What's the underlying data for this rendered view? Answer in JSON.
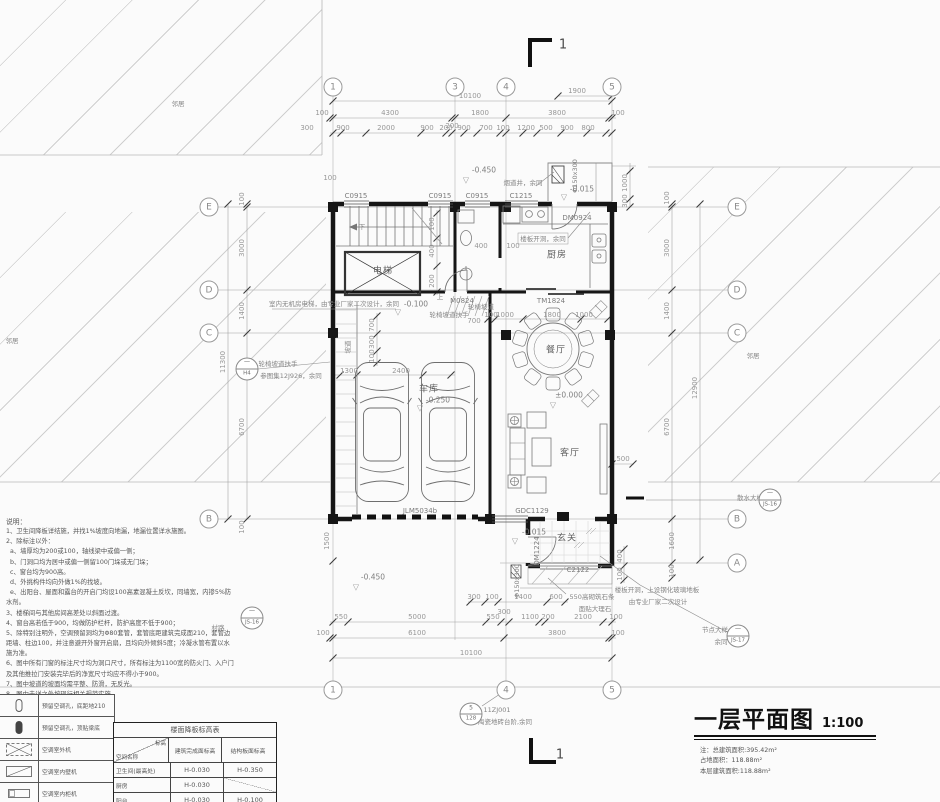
{
  "title_block": {
    "title": "一层平面图",
    "scale": "1:100",
    "notes": [
      "注：总建筑面积:395.42m²",
      "占地面积：118.88m²",
      "本层建筑面积:118.88m²"
    ]
  },
  "colors": {
    "paper": "#fbfbfb",
    "wall": "#161616",
    "medium_line": "#707070",
    "dim_text": "#979797",
    "hatch": "#cfcfcf"
  },
  "notes": {
    "heading": "说明：",
    "items": [
      "1、卫生间降板详结施，并找1%坡度向地漏，地漏位置详水施图。",
      "2、除标注以外：",
      "  a、墙厚均为200或100，轴线梁中或偏一侧；",
      "  b、门洞口均为居中或偏一侧留100门垛或无门垛；",
      "  c、窗台均为900高。",
      "  d、外挑构件均向外做1%的找坡。",
      "  e、出阳台、屋面和露台的开启门均设100高素混凝土反坎，同墙宽，内掺5%防水剂。",
      "3、楼梯间与其他房间高差处以斜面过渡。",
      "4、窗台高若低于900，均做防护栏杆，防护高度不低于900；",
      "5、除特别注明外，空调预留洞均为Φ80套管，套管底距建筑完成面210，套管边距墙、柱边100，并注意避开外窗开启扇，且均向外倾斜5度；冷凝水管布置以水施为准。",
      "6、图中所有门窗的标注尺寸均为洞口尺寸，所有标注为1100宽的防火门、入户门及其他推拉门安装完毕后的净宽尺寸均应不得小于900。",
      "7、图中坡道的坡面均需平整、防滑，无反光。",
      "8、图中未详之处按现行相关规范实施。"
    ]
  },
  "legend": {
    "rows": [
      {
        "symbol": "ac-hole-pill-outline",
        "desc": "预留空调孔，底距地210"
      },
      {
        "symbol": "ac-hole-pill-filled",
        "desc": "预留空调孔，顶贴梁底"
      },
      {
        "symbol": "ac-outdoor-unit",
        "desc": "空调室外机"
      },
      {
        "symbol": "ac-indoor-wall-unit",
        "desc": "空调室内壁机"
      },
      {
        "symbol": "ac-indoor-cabinet-unit",
        "desc": "空调室内柜机"
      }
    ]
  },
  "elevation_table": {
    "title": "楼面降板标高表",
    "corner_top": "标高",
    "corner_bottom": "空间名称",
    "headers": [
      "建筑完成面标高",
      "结构板面标高"
    ],
    "rows": [
      [
        "卫生间(最高处)",
        "H-0.030",
        "H-0.350"
      ],
      [
        "厨房",
        "H-0.030",
        ""
      ],
      [
        "阳台",
        "H-0.030",
        "H-0.100"
      ]
    ]
  },
  "detail_bubbles": [
    {
      "n": "detail-bubble-h4",
      "top": "一",
      "bottom": "H4",
      "x": 247,
      "y": 369
    },
    {
      "n": "detail-bubble-steps",
      "top": "5",
      "bottom": "128",
      "x": 471,
      "y": 714
    },
    {
      "n": "detail-bubble-node",
      "top": "一",
      "bottom": "JS-17",
      "x": 738,
      "y": 636
    },
    {
      "n": "detail-bubble-apron",
      "top": "一",
      "bottom": "JS-16",
      "x": 770,
      "y": 500
    },
    {
      "n": "detail-bubble-road",
      "top": "一",
      "bottom": "JS-16",
      "x": 252,
      "y": 618
    }
  ],
  "plan_labels": [
    {
      "n": "grid-bubble-1-top",
      "t": "1",
      "x": 333,
      "y": 87,
      "c": "bubble"
    },
    {
      "n": "grid-bubble-3-top",
      "t": "3",
      "x": 455,
      "y": 87,
      "c": "bubble"
    },
    {
      "n": "grid-bubble-4-top",
      "t": "4",
      "x": 506,
      "y": 87,
      "c": "bubble"
    },
    {
      "n": "grid-bubble-5-top",
      "t": "5",
      "x": 612,
      "y": 87,
      "c": "bubble"
    },
    {
      "n": "grid-bubble-1-bottom",
      "t": "1",
      "x": 333,
      "y": 690,
      "c": "bubble"
    },
    {
      "n": "grid-bubble-4-bottom",
      "t": "4",
      "x": 506,
      "y": 690,
      "c": "bubble"
    },
    {
      "n": "grid-bubble-5-bottom",
      "t": "5",
      "x": 612,
      "y": 690,
      "c": "bubble"
    },
    {
      "n": "grid-bubble-e-left",
      "t": "E",
      "x": 209,
      "y": 207,
      "c": "bubble"
    },
    {
      "n": "grid-bubble-d-left",
      "t": "D",
      "x": 209,
      "y": 290,
      "c": "bubble"
    },
    {
      "n": "grid-bubble-c-left",
      "t": "C",
      "x": 209,
      "y": 333,
      "c": "bubble"
    },
    {
      "n": "grid-bubble-b-left",
      "t": "B",
      "x": 209,
      "y": 519,
      "c": "bubble"
    },
    {
      "n": "grid-bubble-e-right",
      "t": "E",
      "x": 737,
      "y": 207,
      "c": "bubble"
    },
    {
      "n": "grid-bubble-d-right",
      "t": "D",
      "x": 737,
      "y": 290,
      "c": "bubble"
    },
    {
      "n": "grid-bubble-c-right",
      "t": "C",
      "x": 737,
      "y": 333,
      "c": "bubble"
    },
    {
      "n": "grid-bubble-b-right",
      "t": "B",
      "x": 737,
      "y": 519,
      "c": "bubble"
    },
    {
      "n": "grid-bubble-a-right",
      "t": "A",
      "x": 737,
      "y": 563,
      "c": "bubble"
    },
    {
      "n": "section-mark-label-top",
      "t": "1",
      "x": 563,
      "y": 45,
      "c": "sec"
    },
    {
      "n": "section-mark-label-bottom",
      "t": "1",
      "x": 560,
      "y": 755,
      "c": "sec"
    },
    {
      "n": "dim-top",
      "t": "10100",
      "x": 470,
      "y": 96,
      "c": "dim"
    },
    {
      "n": "dim-top",
      "t": "1900",
      "x": 577,
      "y": 91,
      "c": "dim"
    },
    {
      "n": "dim-top",
      "t": "100",
      "x": 322,
      "y": 113,
      "c": "dim"
    },
    {
      "n": "dim-top",
      "t": "4300",
      "x": 390,
      "y": 113,
      "c": "dim"
    },
    {
      "n": "dim-top",
      "t": "1800",
      "x": 480,
      "y": 113,
      "c": "dim"
    },
    {
      "n": "dim-top",
      "t": "3800",
      "x": 557,
      "y": 113,
      "c": "dim"
    },
    {
      "n": "dim-top",
      "t": "100",
      "x": 618,
      "y": 113,
      "c": "dim"
    },
    {
      "n": "dim-top",
      "t": "200",
      "x": 452,
      "y": 126,
      "c": "dim"
    },
    {
      "n": "dim-top",
      "t": "300",
      "x": 307,
      "y": 128,
      "c": "dim"
    },
    {
      "n": "dim-top",
      "t": "900",
      "x": 343,
      "y": 128,
      "c": "dim"
    },
    {
      "n": "dim-top",
      "t": "2000",
      "x": 386,
      "y": 128,
      "c": "dim"
    },
    {
      "n": "dim-top",
      "t": "900",
      "x": 427,
      "y": 128,
      "c": "dim"
    },
    {
      "n": "dim-top",
      "t": "200",
      "x": 446,
      "y": 128,
      "c": "dim"
    },
    {
      "n": "dim-top",
      "t": "900",
      "x": 464,
      "y": 128,
      "c": "dim"
    },
    {
      "n": "dim-top",
      "t": "700",
      "x": 486,
      "y": 128,
      "c": "dim"
    },
    {
      "n": "dim-top",
      "t": "100",
      "x": 503,
      "y": 128,
      "c": "dim"
    },
    {
      "n": "dim-top",
      "t": "1200",
      "x": 526,
      "y": 128,
      "c": "dim"
    },
    {
      "n": "dim-top",
      "t": "500",
      "x": 546,
      "y": 128,
      "c": "dim"
    },
    {
      "n": "dim-top",
      "t": "900",
      "x": 567,
      "y": 128,
      "c": "dim"
    },
    {
      "n": "dim-top",
      "t": "800",
      "x": 588,
      "y": 128,
      "c": "dim"
    },
    {
      "n": "dim-left-edge",
      "t": "100",
      "x": 330,
      "y": 178,
      "c": "dim"
    },
    {
      "n": "dim-bottom",
      "t": "300",
      "x": 474,
      "y": 597,
      "c": "dim"
    },
    {
      "n": "dim-bottom",
      "t": "100",
      "x": 492,
      "y": 597,
      "c": "dim"
    },
    {
      "n": "dim-bottom",
      "t": "1400",
      "x": 523,
      "y": 597,
      "c": "dim"
    },
    {
      "n": "dim-bottom",
      "t": "600",
      "x": 556,
      "y": 597,
      "c": "dim"
    },
    {
      "n": "dim-bottom",
      "t": "300",
      "x": 504,
      "y": 612,
      "c": "dim"
    },
    {
      "n": "dim-bottom",
      "t": "550",
      "x": 341,
      "y": 617,
      "c": "dim"
    },
    {
      "n": "dim-bottom",
      "t": "5000",
      "x": 417,
      "y": 617,
      "c": "dim"
    },
    {
      "n": "dim-bottom",
      "t": "550",
      "x": 493,
      "y": 617,
      "c": "dim"
    },
    {
      "n": "dim-bottom",
      "t": "1100",
      "x": 530,
      "y": 617,
      "c": "dim"
    },
    {
      "n": "dim-bottom",
      "t": "200",
      "x": 548,
      "y": 617,
      "c": "dim"
    },
    {
      "n": "dim-bottom",
      "t": "2100",
      "x": 583,
      "y": 617,
      "c": "dim"
    },
    {
      "n": "dim-bottom",
      "t": "100",
      "x": 616,
      "y": 617,
      "c": "dim"
    },
    {
      "n": "dim-bottom",
      "t": "100",
      "x": 323,
      "y": 633,
      "c": "dim"
    },
    {
      "n": "dim-bottom",
      "t": "6100",
      "x": 417,
      "y": 633,
      "c": "dim"
    },
    {
      "n": "dim-bottom",
      "t": "3800",
      "x": 557,
      "y": 633,
      "c": "dim"
    },
    {
      "n": "dim-bottom",
      "t": "100",
      "x": 618,
      "y": 633,
      "c": "dim"
    },
    {
      "n": "dim-bottom",
      "t": "10100",
      "x": 471,
      "y": 653,
      "c": "dim"
    },
    {
      "n": "dim-left",
      "t": "100",
      "x": 242,
      "y": 199,
      "c": "dimv",
      "r": -90
    },
    {
      "n": "dim-left",
      "t": "3000",
      "x": 242,
      "y": 248,
      "c": "dimv",
      "r": -90
    },
    {
      "n": "dim-left",
      "t": "1400",
      "x": 242,
      "y": 311,
      "c": "dimv",
      "r": -90
    },
    {
      "n": "dim-left",
      "t": "6700",
      "x": 242,
      "y": 427,
      "c": "dimv",
      "r": -90
    },
    {
      "n": "dim-left",
      "t": "100",
      "x": 242,
      "y": 527,
      "c": "dimv",
      "r": -90
    },
    {
      "n": "dim-left",
      "t": "11300",
      "x": 223,
      "y": 362,
      "c": "dimv",
      "r": -90
    },
    {
      "n": "dim-left",
      "t": "1500",
      "x": 327,
      "y": 541,
      "c": "dimv",
      "r": -90
    },
    {
      "n": "dim-right",
      "t": "100",
      "x": 667,
      "y": 198,
      "c": "dimv",
      "r": -90
    },
    {
      "n": "dim-right",
      "t": "3000",
      "x": 667,
      "y": 248,
      "c": "dimv",
      "r": -90
    },
    {
      "n": "dim-right",
      "t": "1400",
      "x": 667,
      "y": 311,
      "c": "dimv",
      "r": -90
    },
    {
      "n": "dim-right",
      "t": "6700",
      "x": 667,
      "y": 427,
      "c": "dimv",
      "r": -90
    },
    {
      "n": "dim-right",
      "t": "1600",
      "x": 672,
      "y": 541,
      "c": "dimv",
      "r": -90
    },
    {
      "n": "dim-right",
      "t": "100",
      "x": 672,
      "y": 571,
      "c": "dimv",
      "r": -90
    },
    {
      "n": "dim-right",
      "t": "12900",
      "x": 695,
      "y": 388,
      "c": "dimv",
      "r": -90
    },
    {
      "n": "dim-right",
      "t": "1000",
      "x": 625,
      "y": 183,
      "c": "dimv",
      "r": -90
    },
    {
      "n": "dim-right",
      "t": "300",
      "x": 625,
      "y": 201,
      "c": "dimv",
      "r": -90
    },
    {
      "n": "dim-inner",
      "t": "700",
      "x": 372,
      "y": 325,
      "c": "dimv",
      "r": -90
    },
    {
      "n": "dim-inner",
      "t": "300",
      "x": 372,
      "y": 342,
      "c": "dimv",
      "r": -90
    },
    {
      "n": "dim-inner",
      "t": "100",
      "x": 372,
      "y": 356,
      "c": "dimv",
      "r": -90
    },
    {
      "n": "dim-inner",
      "t": "100",
      "x": 432,
      "y": 224,
      "c": "dimv",
      "r": -90
    },
    {
      "n": "dim-inner",
      "t": "400",
      "x": 432,
      "y": 251,
      "c": "dimv",
      "r": -90
    },
    {
      "n": "dim-inner",
      "t": "200",
      "x": 432,
      "y": 281,
      "c": "dimv",
      "r": -90
    },
    {
      "n": "dim-inner",
      "t": "400",
      "x": 481,
      "y": 246,
      "c": "dim"
    },
    {
      "n": "dim-inner",
      "t": "100",
      "x": 513,
      "y": 246,
      "c": "dim"
    },
    {
      "n": "dim-inner",
      "t": "700",
      "x": 474,
      "y": 321,
      "c": "dim"
    },
    {
      "n": "dim-inner",
      "t": "1300",
      "x": 349,
      "y": 371,
      "c": "dim"
    },
    {
      "n": "dim-inner",
      "t": "2400",
      "x": 401,
      "y": 371,
      "c": "dim"
    },
    {
      "n": "dim-inner",
      "t": "100",
      "x": 491,
      "y": 315,
      "c": "dim"
    },
    {
      "n": "dim-inner",
      "t": "1000",
      "x": 505,
      "y": 315,
      "c": "dim"
    },
    {
      "n": "dim-inner",
      "t": "1800",
      "x": 552,
      "y": 315,
      "c": "dim"
    },
    {
      "n": "dim-inner",
      "t": "1000",
      "x": 584,
      "y": 315,
      "c": "dim"
    },
    {
      "n": "dim-inner",
      "t": "500",
      "x": 623,
      "y": 459,
      "c": "dim"
    },
    {
      "n": "dim-inner",
      "t": "400",
      "x": 620,
      "y": 556,
      "c": "dimv",
      "r": -90
    },
    {
      "n": "dim-inner",
      "t": "100",
      "x": 620,
      "y": 574,
      "c": "dimv",
      "r": -90
    },
    {
      "n": "window-label",
      "t": "C0915",
      "x": 356,
      "y": 196,
      "c": "lbl"
    },
    {
      "n": "window-label",
      "t": "C0915",
      "x": 440,
      "y": 196,
      "c": "lbl"
    },
    {
      "n": "window-label",
      "t": "C0915",
      "x": 477,
      "y": 196,
      "c": "lbl"
    },
    {
      "n": "window-label",
      "t": "C1215",
      "x": 521,
      "y": 196,
      "c": "lbl"
    },
    {
      "n": "door-label",
      "t": "DM0924",
      "x": 577,
      "y": 218,
      "c": "lbl"
    },
    {
      "n": "door-label",
      "t": "TM1824",
      "x": 551,
      "y": 301,
      "c": "lbl"
    },
    {
      "n": "door-label",
      "t": "M0824",
      "x": 462,
      "y": 301,
      "c": "lbl"
    },
    {
      "n": "door-label",
      "t": "JLM5034b",
      "x": 420,
      "y": 511,
      "c": "lbl"
    },
    {
      "n": "window-label",
      "t": "GDC1129",
      "x": 532,
      "y": 511,
      "c": "lbl"
    },
    {
      "n": "window-label",
      "t": "C2122",
      "x": 578,
      "y": 570,
      "c": "lbl"
    },
    {
      "n": "door-label",
      "t": "DM1224",
      "x": 537,
      "y": 551,
      "c": "lbl",
      "r": -90
    },
    {
      "n": "room-label-elevator",
      "t": "电梯",
      "x": 383,
      "y": 270,
      "c": "room"
    },
    {
      "n": "room-label-kitchen",
      "t": "厨房",
      "x": 557,
      "y": 254,
      "c": "room"
    },
    {
      "n": "room-label-dining",
      "t": "餐厅",
      "x": 556,
      "y": 349,
      "c": "room"
    },
    {
      "n": "room-label-garage",
      "t": "车库",
      "x": 429,
      "y": 388,
      "c": "room"
    },
    {
      "n": "room-label-living",
      "t": "客厅",
      "x": 570,
      "y": 452,
      "c": "room"
    },
    {
      "n": "room-label-foyer",
      "t": "玄关",
      "x": 567,
      "y": 537,
      "c": "room"
    },
    {
      "n": "elevation-value",
      "t": "-0.450",
      "x": 484,
      "y": 170,
      "c": "elev"
    },
    {
      "n": "elevation-value",
      "t": "-0.015",
      "x": 582,
      "y": 189,
      "c": "elev"
    },
    {
      "n": "elevation-value",
      "t": "-0.100",
      "x": 416,
      "y": 304,
      "c": "elev"
    },
    {
      "n": "elevation-value",
      "t": "±0.000",
      "x": 569,
      "y": 395,
      "c": "elev"
    },
    {
      "n": "elevation-value",
      "t": "-0.250",
      "x": 438,
      "y": 400,
      "c": "elev"
    },
    {
      "n": "elevation-value",
      "t": "-0.015",
      "x": 534,
      "y": 532,
      "c": "elev"
    },
    {
      "n": "elevation-value",
      "t": "-0.450",
      "x": 373,
      "y": 577,
      "c": "elev"
    },
    {
      "n": "elevation-marker",
      "t": "▽",
      "x": 466,
      "y": 180,
      "c": "tri"
    },
    {
      "n": "elevation-marker",
      "t": "▽",
      "x": 564,
      "y": 197,
      "c": "tri"
    },
    {
      "n": "elevation-marker",
      "t": "▽",
      "x": 398,
      "y": 312,
      "c": "tri"
    },
    {
      "n": "elevation-marker",
      "t": "▽",
      "x": 553,
      "y": 405,
      "c": "tri"
    },
    {
      "n": "elevation-marker",
      "t": "▽",
      "x": 420,
      "y": 408,
      "c": "tri"
    },
    {
      "n": "elevation-marker",
      "t": "▽",
      "x": 515,
      "y": 541,
      "c": "tri"
    },
    {
      "n": "elevation-marker",
      "t": "▽",
      "x": 356,
      "y": 587,
      "c": "tri"
    },
    {
      "n": "annotation-flue",
      "t": "烟道井，余同",
      "x": 523,
      "y": 182,
      "c": "ann"
    },
    {
      "n": "annotation-slab-opening",
      "t": "楼板开洞，余同",
      "x": 543,
      "y": 238,
      "c": "ann"
    },
    {
      "n": "annotation-duct-size",
      "t": "Φ150x300",
      "x": 575,
      "y": 176,
      "c": "ann",
      "r": -90
    },
    {
      "n": "annotation-duct-size",
      "t": "Φ150x300",
      "x": 517,
      "y": 581,
      "c": "ann",
      "r": -90
    },
    {
      "n": "annotation-elevator-note",
      "t": "室内无机房电梯，由专业厂家二次设计，余同",
      "x": 334,
      "y": 303,
      "c": "ann"
    },
    {
      "n": "annotation-ramp-handrail",
      "t": "轮椅坡道扶手",
      "x": 278,
      "y": 363,
      "c": "ann"
    },
    {
      "n": "annotation-ramp-handrail-ref",
      "t": "参图集12J926，余同",
      "x": 291,
      "y": 375,
      "c": "ann"
    },
    {
      "n": "annotation-ramp-handrail",
      "t": "轮椅坡道扶手",
      "x": 449,
      "y": 314,
      "c": "ann"
    },
    {
      "n": "annotation-ramp",
      "t": "轮椅坡道",
      "x": 481,
      "y": 306,
      "c": "ann"
    },
    {
      "n": "annotation-ramp-v",
      "t": "坡道",
      "x": 347,
      "y": 347,
      "c": "ann",
      "r": -90
    },
    {
      "n": "annotation-stone-sill",
      "t": "550高砌筑石条",
      "x": 592,
      "y": 596,
      "c": "ann"
    },
    {
      "n": "annotation-stone-sill2",
      "t": "面贴大理石",
      "x": 595,
      "y": 608,
      "c": "ann"
    },
    {
      "n": "annotation-glass-floor",
      "t": "楼板开洞，上设钢化玻璃地板",
      "x": 657,
      "y": 589,
      "c": "ann"
    },
    {
      "n": "annotation-glass-floor2",
      "t": "由专业厂家二次设计",
      "x": 658,
      "y": 601,
      "c": "ann"
    },
    {
      "n": "annotation-node-detail",
      "t": "节点大样",
      "x": 715,
      "y": 629,
      "c": "ann"
    },
    {
      "n": "annotation-node-detail2",
      "t": "余同",
      "x": 721,
      "y": 641,
      "c": "ann"
    },
    {
      "n": "annotation-apron-detail",
      "t": "散水大样",
      "x": 750,
      "y": 497,
      "c": "ann"
    },
    {
      "n": "annotation-step-ref",
      "t": "11ZJ001",
      "x": 497,
      "y": 710,
      "c": "ann"
    },
    {
      "n": "annotation-step-ref2",
      "t": "陶瓷地砖台阶,余同",
      "x": 505,
      "y": 721,
      "c": "ann"
    },
    {
      "n": "annotation-road",
      "t": "村路",
      "x": 218,
      "y": 627,
      "c": "ann"
    },
    {
      "n": "annotation-neighbor",
      "t": "邻居",
      "x": 178,
      "y": 103,
      "c": "ann"
    },
    {
      "n": "annotation-neighbor",
      "t": "邻居",
      "x": 12,
      "y": 340,
      "c": "ann"
    },
    {
      "n": "annotation-neighbor",
      "t": "邻居",
      "x": 753,
      "y": 355,
      "c": "ann"
    },
    {
      "n": "annotation-stair-down",
      "t": "下",
      "x": 362,
      "y": 226,
      "c": "ann"
    },
    {
      "n": "annotation-ramp-up",
      "t": "上",
      "x": 440,
      "y": 296,
      "c": "ann"
    }
  ]
}
